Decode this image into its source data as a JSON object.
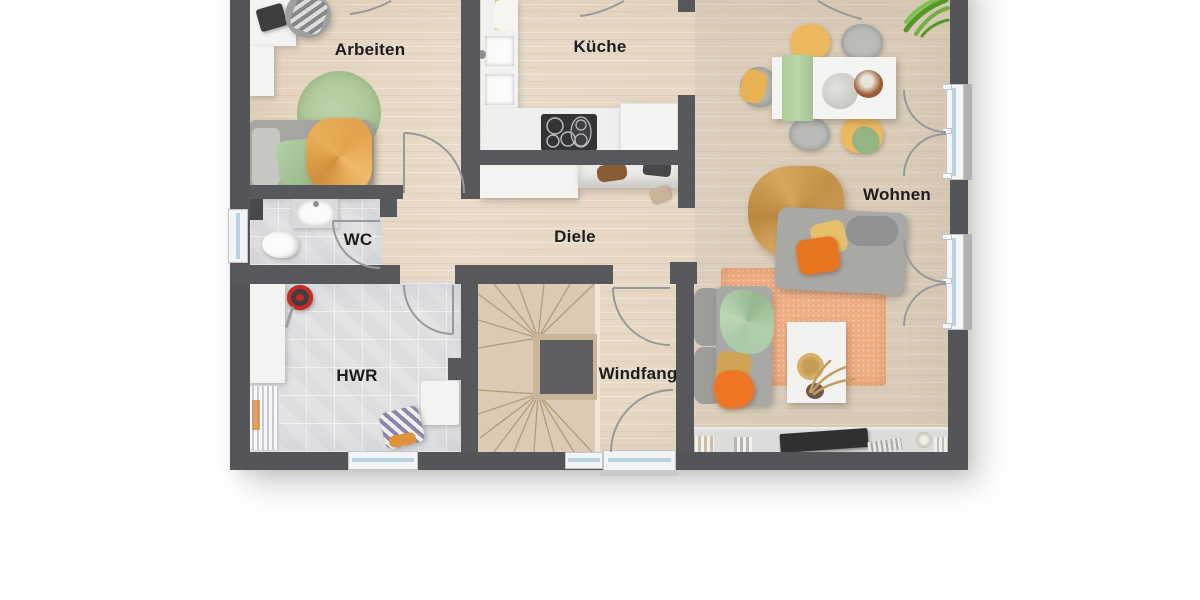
{
  "title": "Grundriss Erdgeschoss",
  "rooms": {
    "arbeiten": "Arbeiten",
    "kueche": "Küche",
    "wohnen": "Wohnen",
    "wc": "WC",
    "diele": "Diele",
    "hwr": "HWR",
    "windfang": "Windfang"
  },
  "colors": {
    "wall": "#56585b",
    "floor_wood": "#e8dbc9",
    "floor_tile": "#e2e3e5",
    "stair_wood": "#dccbb4",
    "window_glass": "#b9d3e3",
    "rug_green": "#b4cc9f",
    "rug_orange": "#efad83",
    "accent_orange": "#e8751f",
    "accent_camel": "#cf9d56",
    "accent_yellow": "#ecb95f",
    "accent_green": "#a9c9a4",
    "sofa_gray": "#a6a6a3",
    "plant_green": "#5fa332"
  }
}
